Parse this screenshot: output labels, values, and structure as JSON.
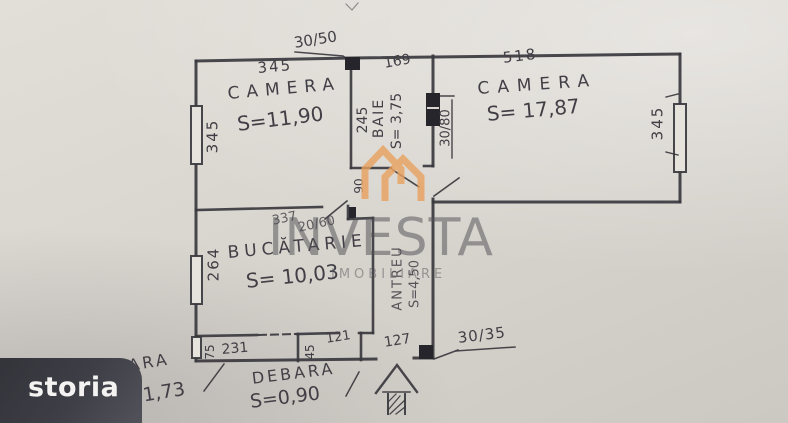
{
  "logo": {
    "text": "storia"
  },
  "watermark": {
    "brand": "INVESTA",
    "tagline": "IMOBILIARE"
  },
  "plan": {
    "rooms": {
      "camera1": {
        "name": "CAMERA",
        "area": "S=11,90"
      },
      "camera2": {
        "name": "CAMERA",
        "area": "S= 17,87"
      },
      "baie": {
        "name": "BAIE",
        "area": "S= 3,75"
      },
      "bucatarie": {
        "name": "BUCĂTARIE",
        "area": "S= 10,03"
      },
      "antreu": {
        "name": "ANTREU",
        "area": "S=4,50"
      },
      "camara": {
        "name": "CAMARA",
        "area": "S=1,73"
      },
      "debara": {
        "name": "DEBARA",
        "area": "S=0,90"
      }
    },
    "dimensions": {
      "camera1_width": "345",
      "camera1_height": "345",
      "baie_width": "169",
      "baie_height": "245",
      "baie_door": "90",
      "camera2_width": "518",
      "camera2_height": "345",
      "bucatarie_width": "337",
      "bucatarie_height": "264",
      "camara_width": "231",
      "camara_depth": "75",
      "debara_width": "121",
      "debara_depth": "45",
      "hol_width": "127"
    },
    "vents": {
      "top": "30/50",
      "baie": "30/80",
      "hol": "30/35",
      "bucatarie": "20/60"
    }
  }
}
